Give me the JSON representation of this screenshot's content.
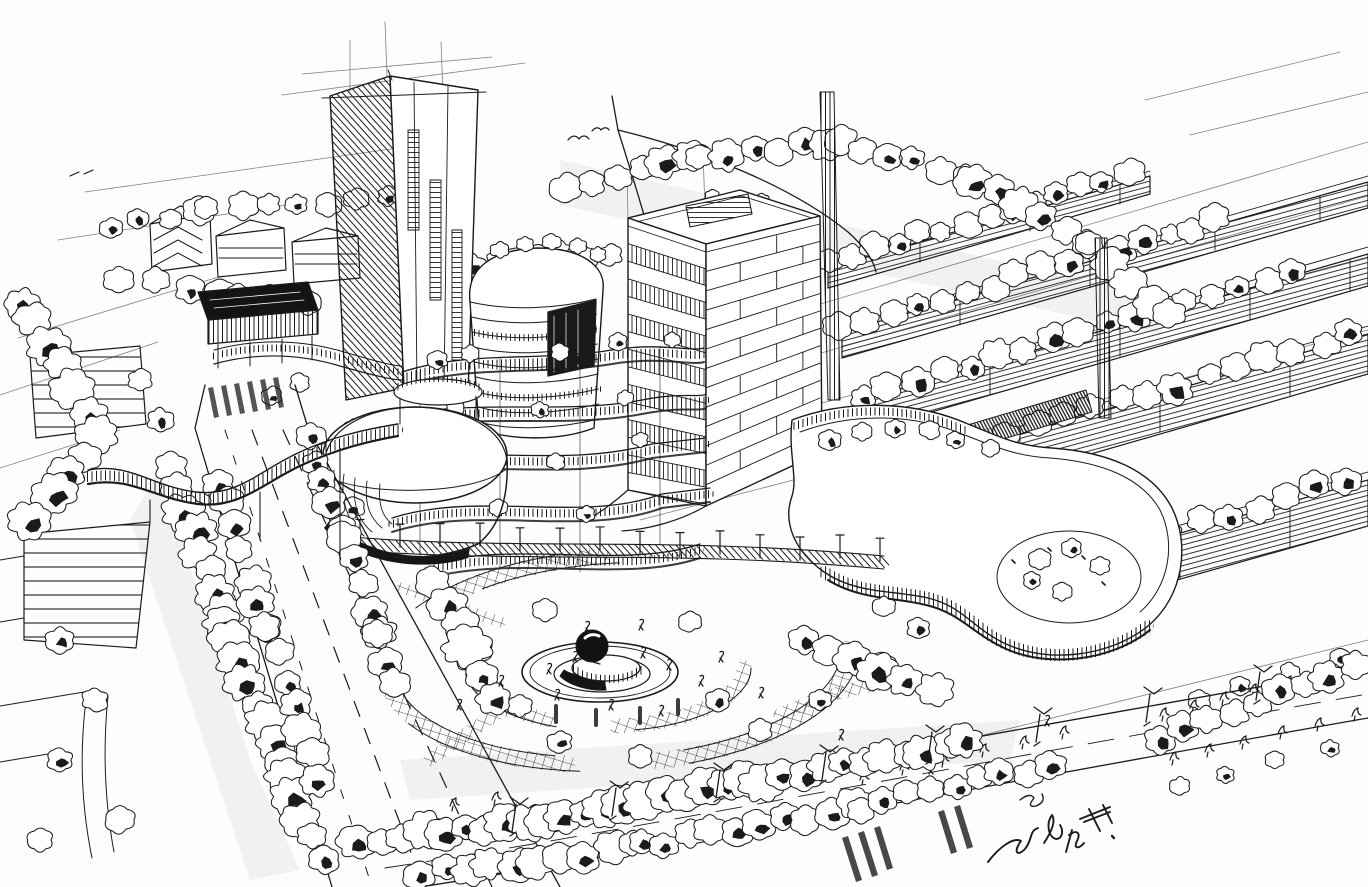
{
  "artwork": {
    "kind": "hand-drawn ink perspective sketch",
    "signature_text": "朗羊",
    "signature_note": "handwritten artist signature, partially legible Chinese characters, lower right"
  },
  "palette": {
    "paper": "#fdfdfc",
    "ink": "#1b1b1b",
    "faint_line": "#555555"
  },
  "scene": {
    "labels": {
      "sketch": "aerial perspective ink sketch of a mixed-use urban development",
      "tall_tower": "tall slab high-rise tower",
      "office_tower": "mid-rise office tower with banded floors and rooftop penthouse",
      "round_tower": "curved glass mid-rise tower",
      "dome": "elliptical dome pavilion",
      "terraces": "stepped curving podium terraces with roof planting",
      "right_podium": "sinuous landscaped podium building with rounded glazed end",
      "housing_rows": "receding rows of residential slab blocks among trees",
      "park": "central landscaped park with cross-hatched ring paths",
      "fountain": "circular fountain plaza with round sculpture on plinth",
      "bridge": "s-curved elevated pedestrian bridge over avenue",
      "avenue": "tree-lined avenue with dashed lane markings and crosswalk",
      "bottom_road": "foreground road with street lamps and crosswalks",
      "houses": "low-rise houses among trees, upper left",
      "signature": "artist signature scribble"
    }
  }
}
